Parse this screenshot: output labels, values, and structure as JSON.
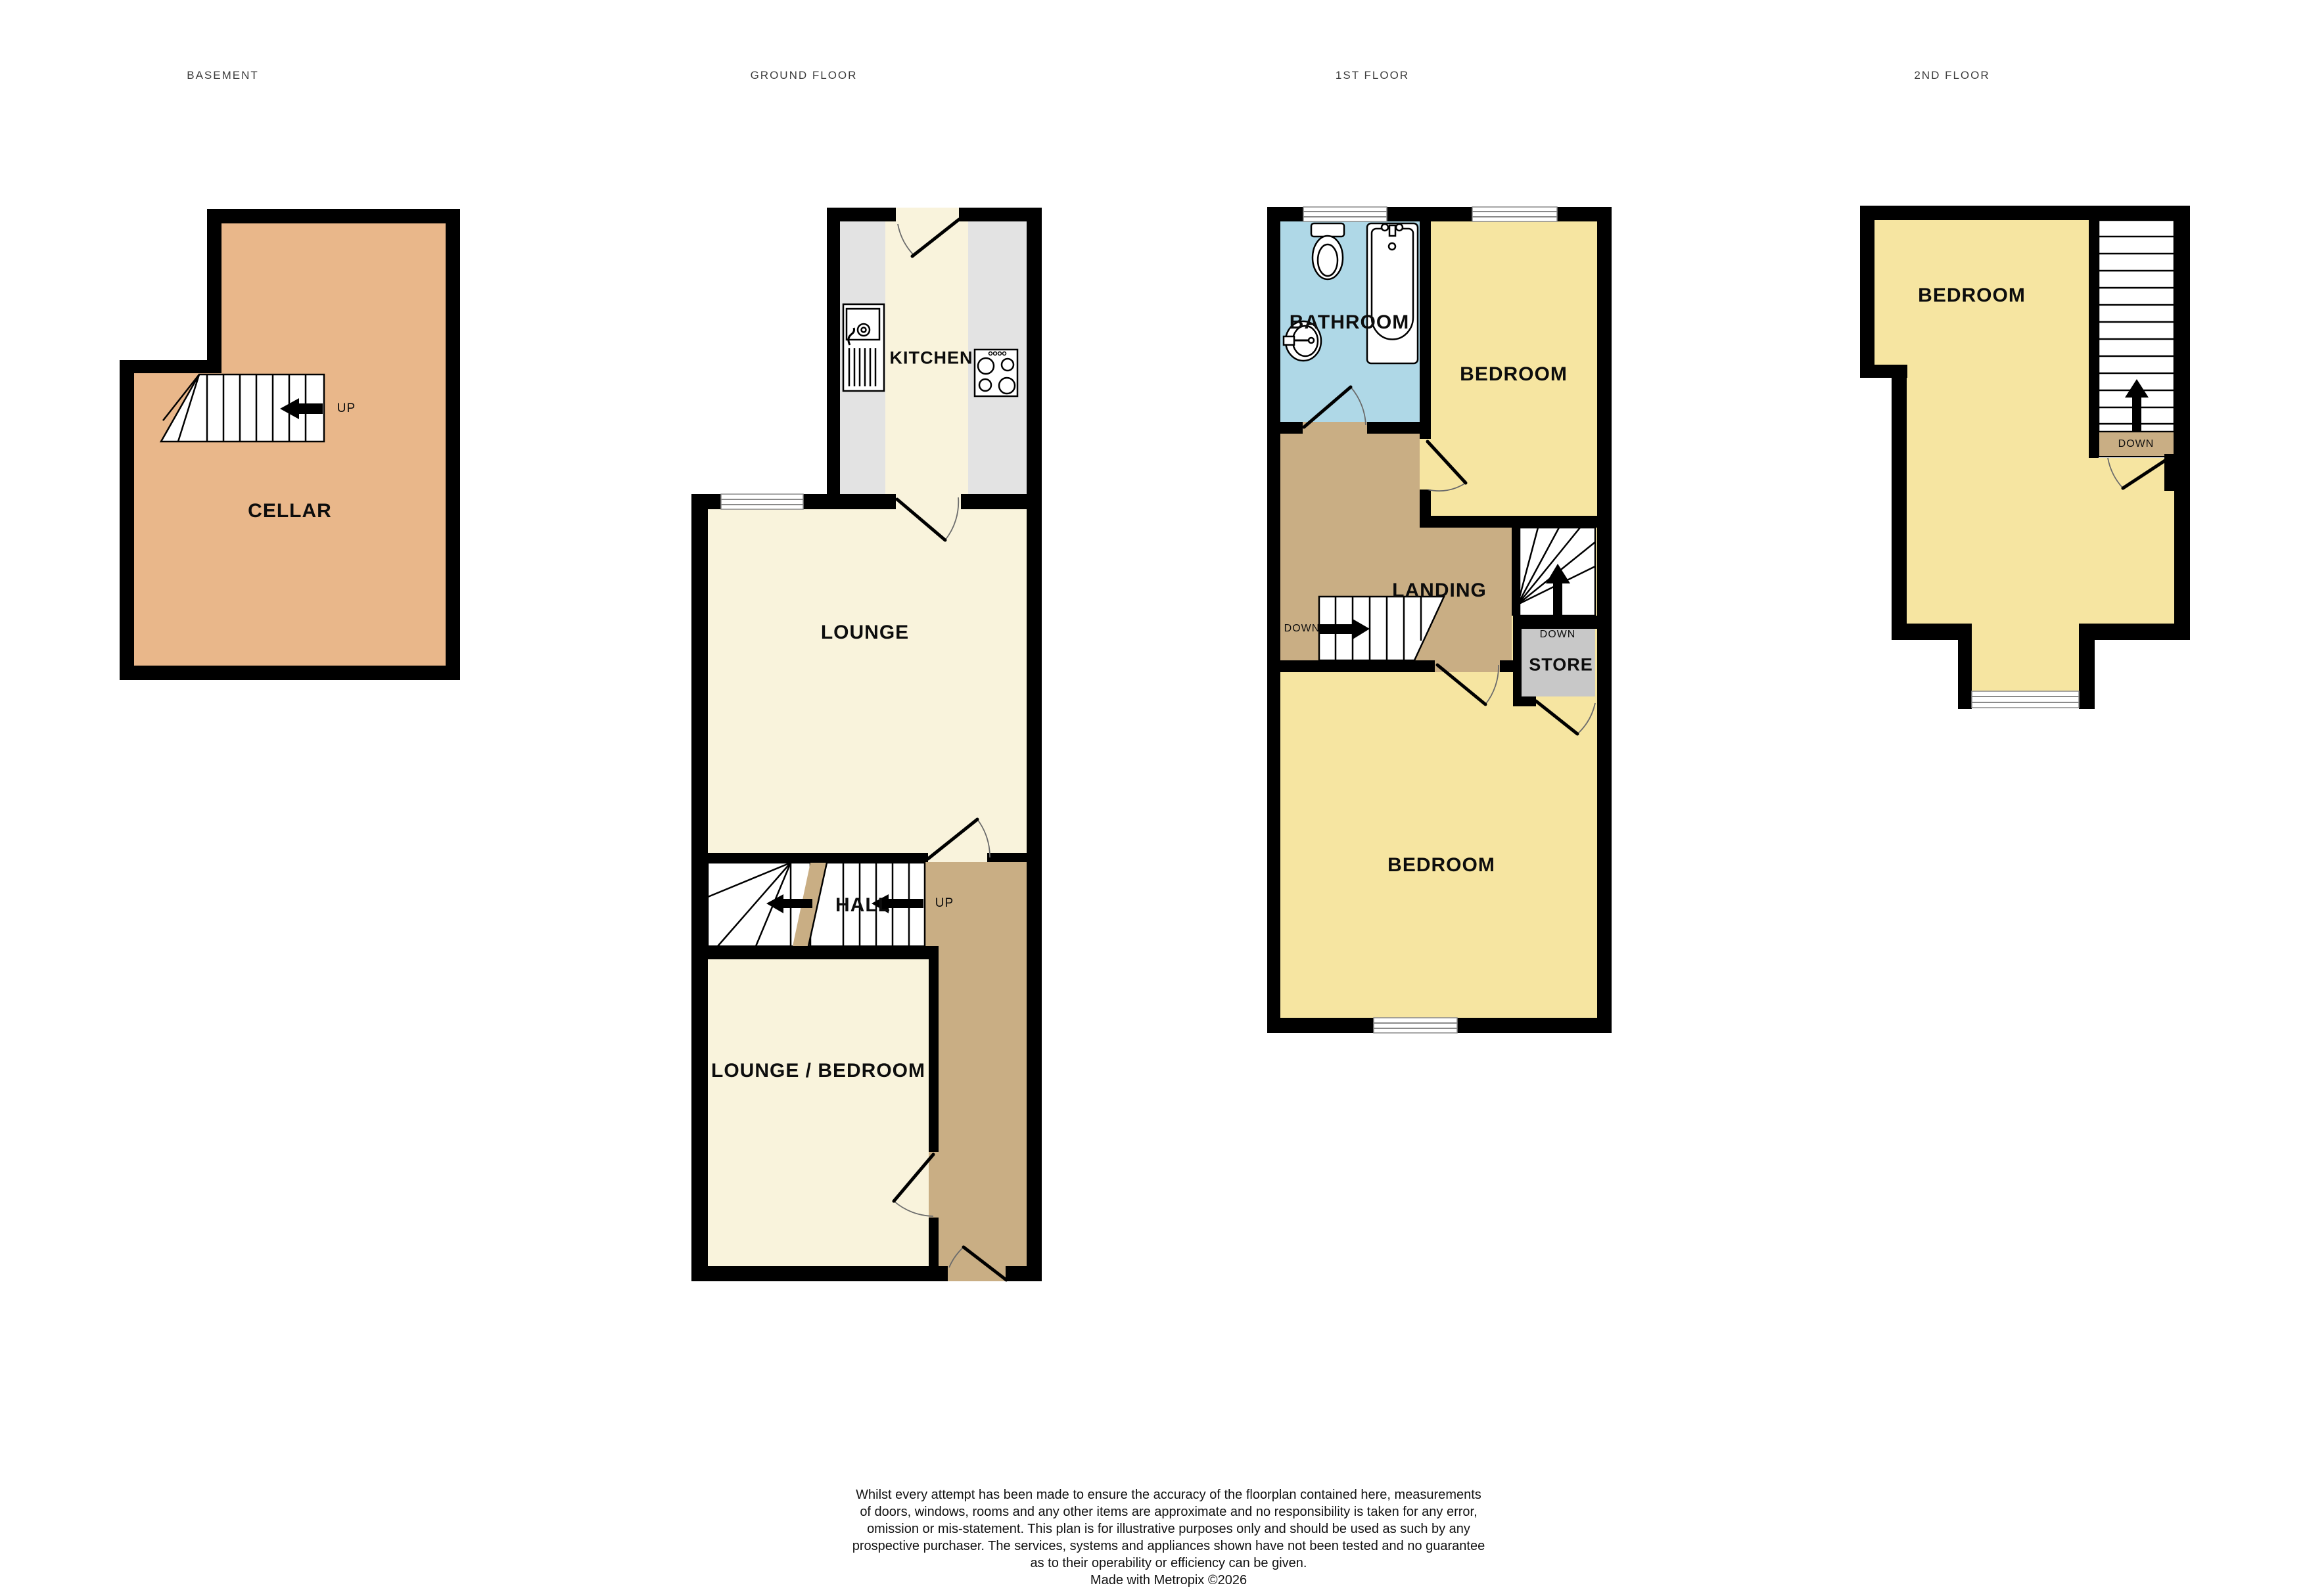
{
  "document_type": "floorplan",
  "floor_titles": {
    "basement": "BASEMENT",
    "ground": "GROUND FLOOR",
    "first": "1ST FLOOR",
    "second": "2ND FLOOR"
  },
  "rooms": {
    "cellar": "CELLAR",
    "kitchen": "KITCHEN",
    "lounge": "LOUNGE",
    "hall": "HALL",
    "lounge_bedroom": "LOUNGE / BEDROOM",
    "bathroom": "BATHROOM",
    "bedroom_first_front": "BEDROOM",
    "landing": "LANDING",
    "store": "STORE",
    "bedroom_first_rear": "BEDROOM",
    "bedroom_second": "BEDROOM"
  },
  "stair_labels": {
    "cellar_up": "UP",
    "hall_up": "UP",
    "landing_down": "DOWN",
    "store_down": "DOWN",
    "second_down": "DOWN"
  },
  "disclaimer": {
    "lines": [
      "Whilst every attempt has been made to ensure the accuracy of the floorplan contained here, measurements",
      "of doors, windows, rooms and any other items are approximate and no responsibility is taken for any error,",
      "omission or mis-statement. This plan is for illustrative purposes only and should be used as such by any",
      "prospective purchaser. The services, systems and appliances shown have not been tested and no guarantee",
      "as to their operability or efficiency can be given."
    ],
    "credit": "Made with Metropix ©2026"
  },
  "colors": {
    "wall": "#000000",
    "cellar": "#E9B78A",
    "cream": "#F9F3DC",
    "counter": "#E3E3E3",
    "tan": "#C9AE84",
    "blue": "#AFD8E7",
    "yellow": "#F6E5A1",
    "store": "#C8C8C8"
  }
}
